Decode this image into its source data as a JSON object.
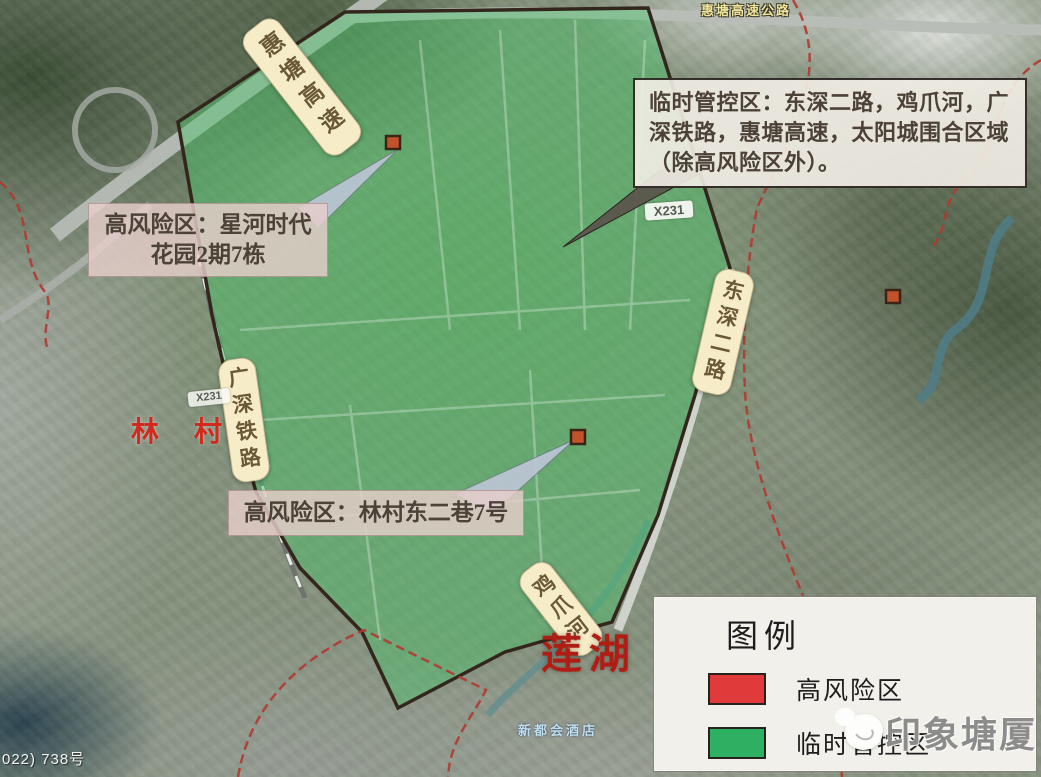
{
  "map": {
    "callouts": {
      "control_zone": {
        "text": "临时管控区：东深二路，鸡爪河，广深铁路，惠塘高速，太阳城围合区域（除高风险区外）。"
      },
      "high_risk_star": {
        "line1": "高风险区：星河时代",
        "line2": "花园2期7栋"
      },
      "high_risk_lincun": {
        "text": "高风险区：林村东二巷7号"
      }
    },
    "road_labels": {
      "huitang_expressway": "惠塘高速",
      "guangshen_railway": "广深铁路",
      "dongshen_2nd_road": "东深二路",
      "jizhua_river": "鸡爪河",
      "huitang_expressway_full": "惠塘高速公路",
      "route_x231": "X231"
    },
    "place_labels": {
      "lincun": "林 村",
      "lianhu": "莲湖",
      "hotel": "新都会酒店"
    },
    "doc_number": "022) 738号",
    "colors": {
      "control_zone_fill": "#4ac369",
      "zone_border": "#33261c",
      "admin_boundary_red": "#b03a30",
      "high_risk_marker": "#c0522c"
    }
  },
  "legend": {
    "title": "图例",
    "items": [
      {
        "label": "高风险区",
        "color": "#e03a3a"
      },
      {
        "label": "临时管控区",
        "color": "#2eb062"
      }
    ]
  },
  "watermark": {
    "text": "印象塘厦"
  }
}
